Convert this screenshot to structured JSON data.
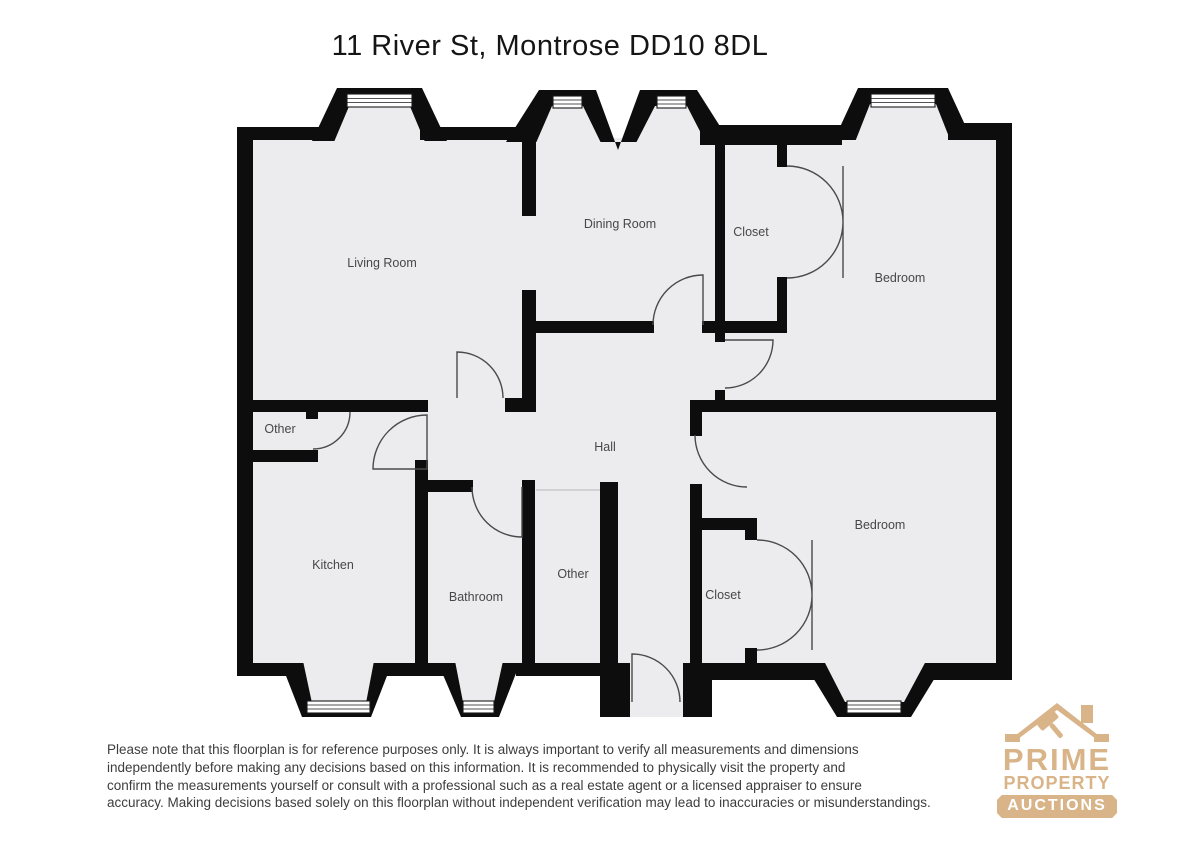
{
  "title": "11 River St, Montrose DD10 8DL",
  "floorplan": {
    "rooms": {
      "living": "Living Room",
      "dining": "Dining Room",
      "closet_top": "Closet",
      "bedroom_top": "Bedroom",
      "other_left": "Other",
      "hall": "Hall",
      "kitchen": "Kitchen",
      "bathroom": "Bathroom",
      "other_bottom": "Other",
      "closet_bottom": "Closet",
      "bedroom_bottom": "Bedroom"
    },
    "colors": {
      "wall": "#0d0d0d",
      "floor": "#ececee",
      "door_arc": "#4a4a4a"
    }
  },
  "disclaimer": {
    "lines": [
      "Please note that this floorplan is for reference purposes only. It is always important to verify all measurements and dimensions",
      "independently before making any decisions based on this information. It is recommended to physically visit the property and",
      "confirm the measurements yourself or consult with a professional such as a real estate agent or a licensed appraiser to ensure",
      "accuracy. Making decisions based solely on this floorplan without independent verification may lead to inaccuracies or misunderstandings."
    ]
  },
  "logo": {
    "line1": "PRIME",
    "line2": "PROPERTY",
    "line3": "AUCTIONS",
    "brand_color": "#d9b489"
  }
}
